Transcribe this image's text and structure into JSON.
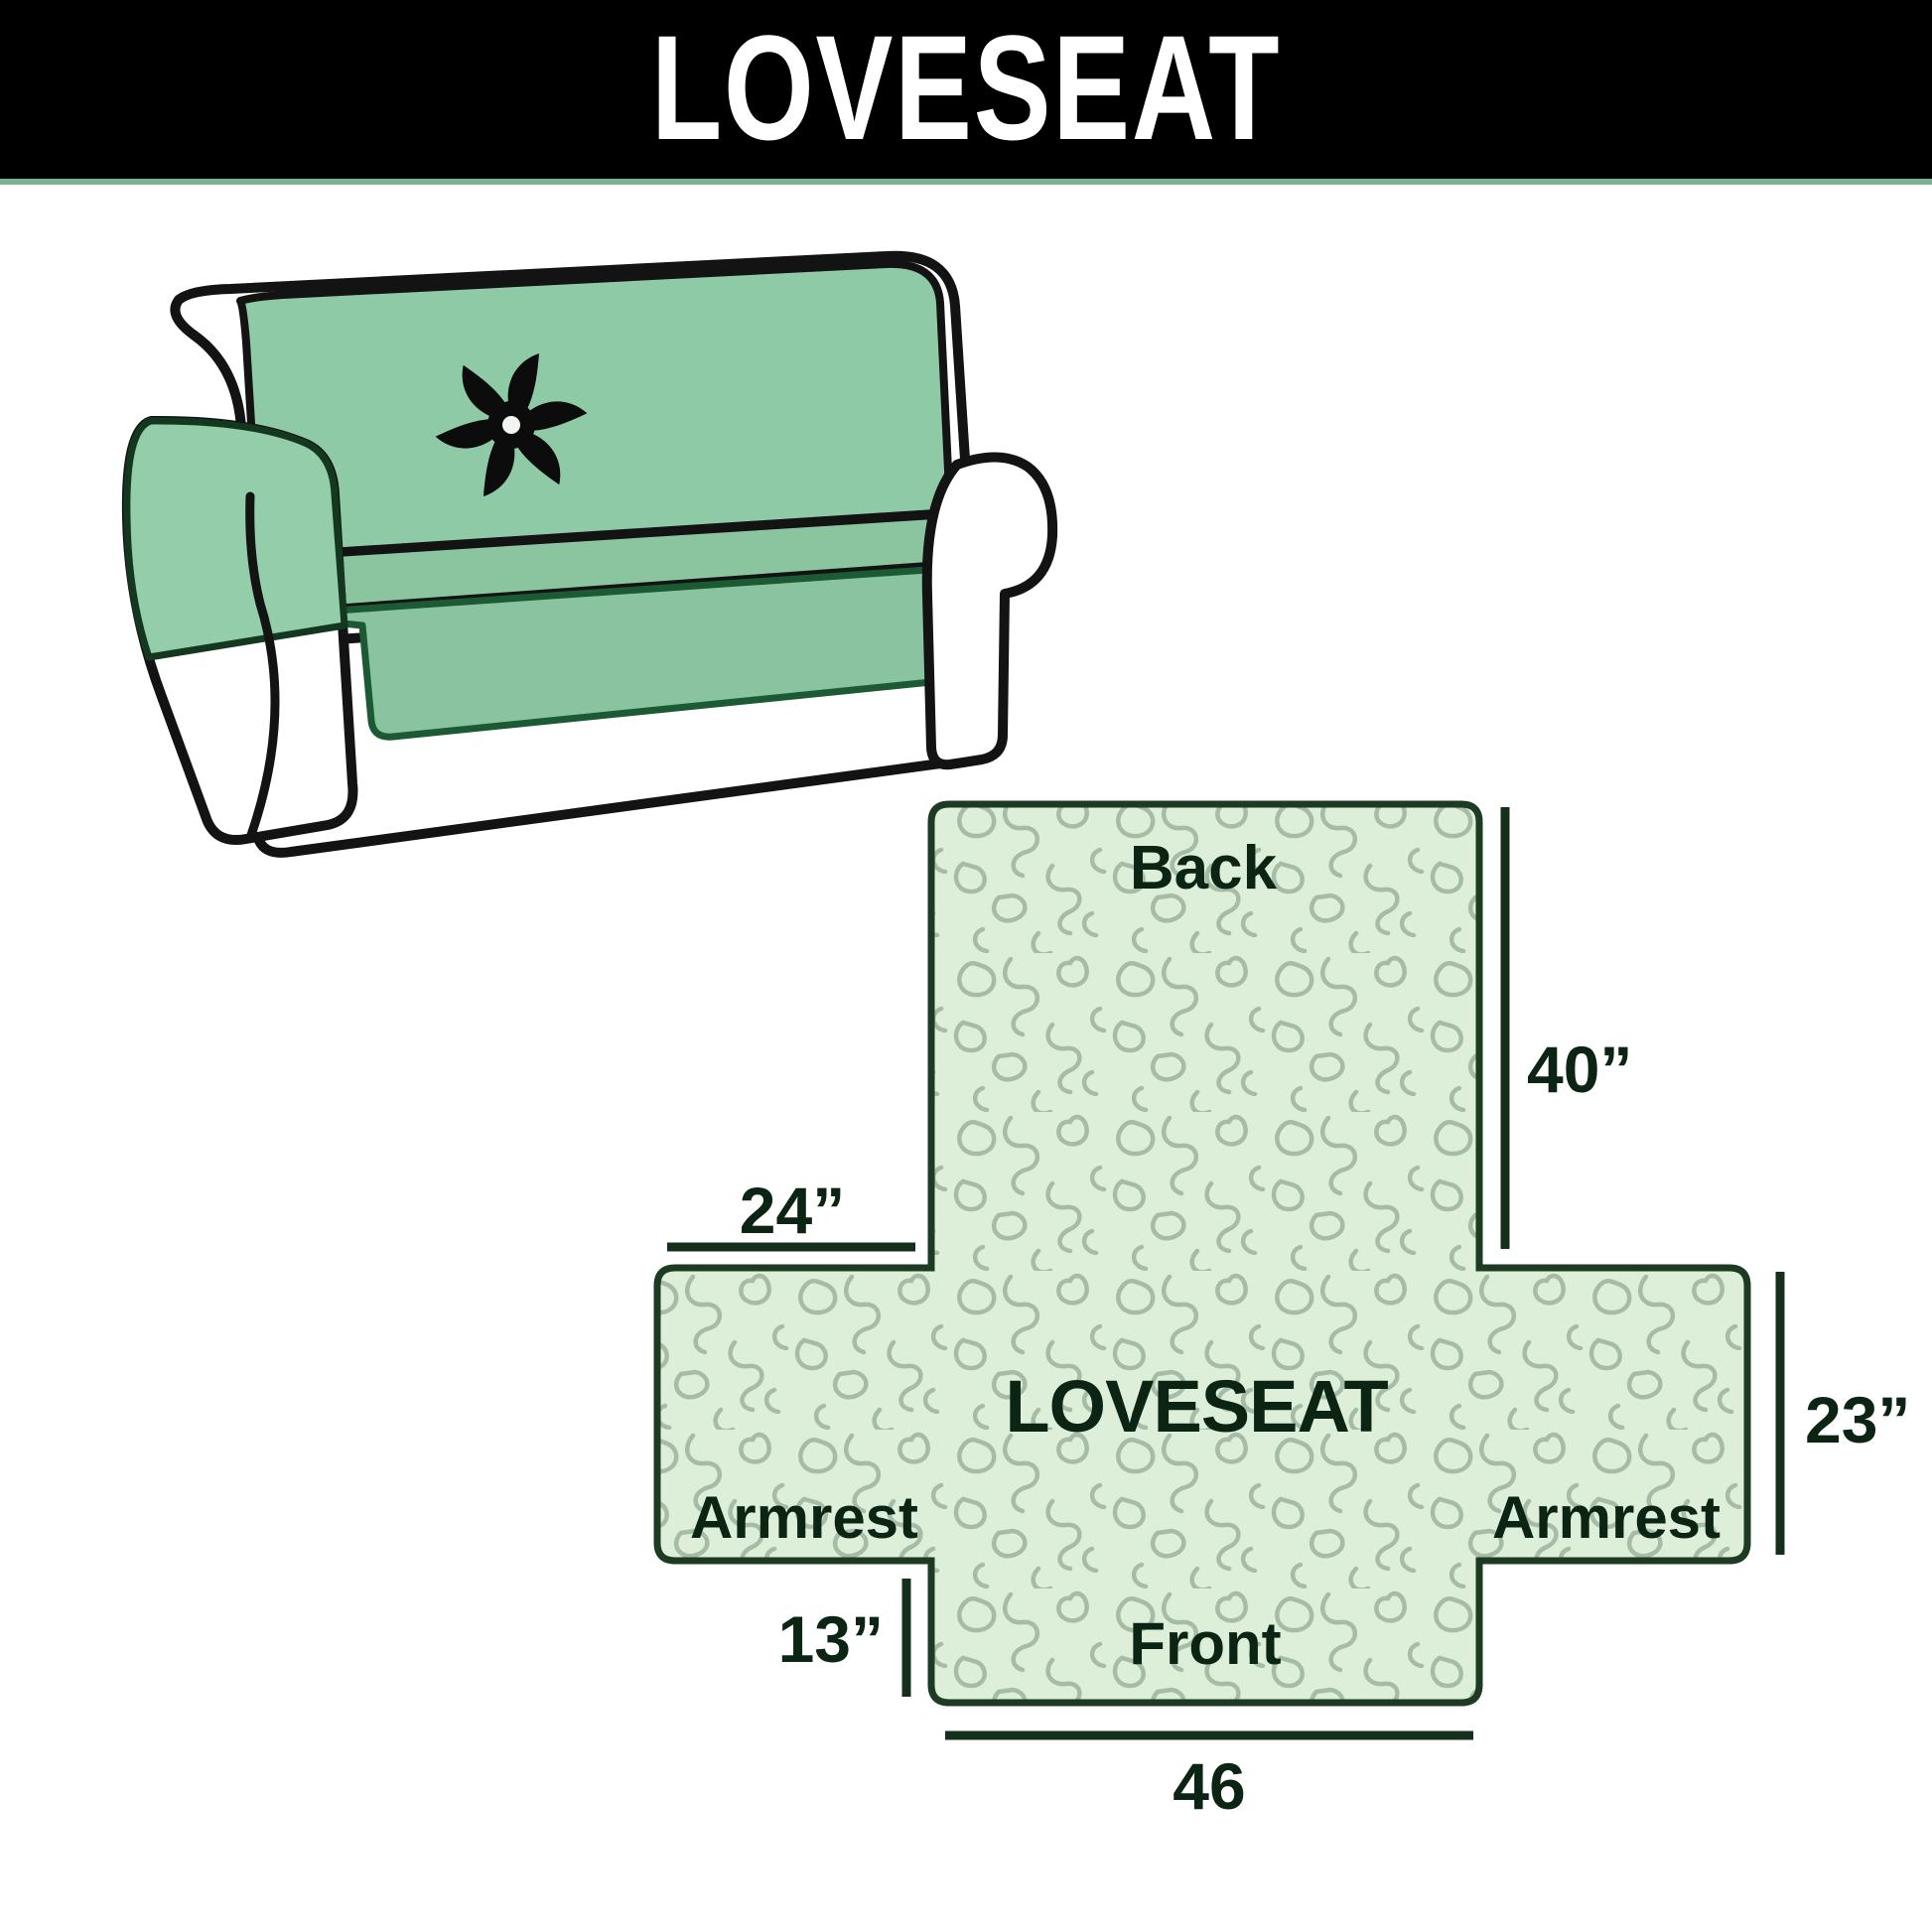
{
  "header": {
    "title": "LOVESEAT",
    "bar_color": "#000000",
    "accent_line_color": "#7bb293"
  },
  "illustration": {
    "alt": "loveseat sofa wearing quilted slipcover",
    "logo_icon": "pinwheel-icon",
    "cover_color": "#8fcaa6",
    "outline_color": "#131313"
  },
  "diagram": {
    "labels": {
      "back": "Back",
      "center": "LOVESEAT",
      "armrest_left": "Armrest",
      "armrest_right": "Armrest",
      "front": "Front"
    },
    "dimensions": {
      "back_height": "40”",
      "back_to_armrest_width": "24”",
      "armrest_height": "23”",
      "front_height": "13”",
      "front_width": "46"
    },
    "style": {
      "fill": "#ddefd9",
      "pattern_line": "#a6bca7",
      "border": "#1c3b22",
      "text": "#0c2414",
      "dim_line": "#14301c"
    }
  }
}
